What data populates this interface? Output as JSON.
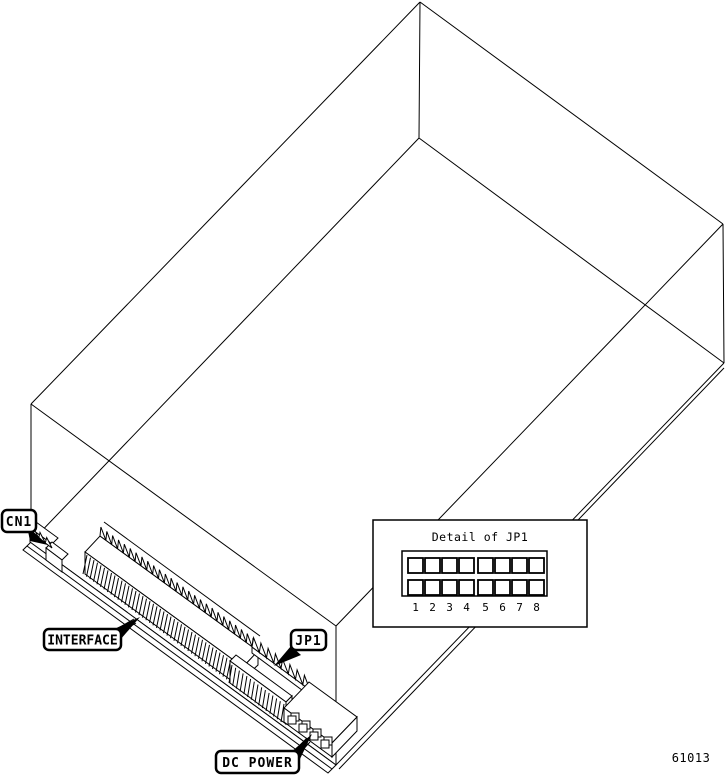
{
  "figure_number": "61013",
  "callouts": {
    "cn1": {
      "label": "CN1"
    },
    "interface": {
      "label": "INTERFACE"
    },
    "jp1": {
      "label": "JP1"
    },
    "dc_power": {
      "label": "DC POWER"
    }
  },
  "detail_inset": {
    "title": "Detail of JP1",
    "rows": 2,
    "columns": 8,
    "pin_numbers": [
      "1",
      "2",
      "3",
      "4",
      "5",
      "6",
      "7",
      "8"
    ]
  },
  "colors": {
    "line": "#000000",
    "background": "#ffffff"
  }
}
